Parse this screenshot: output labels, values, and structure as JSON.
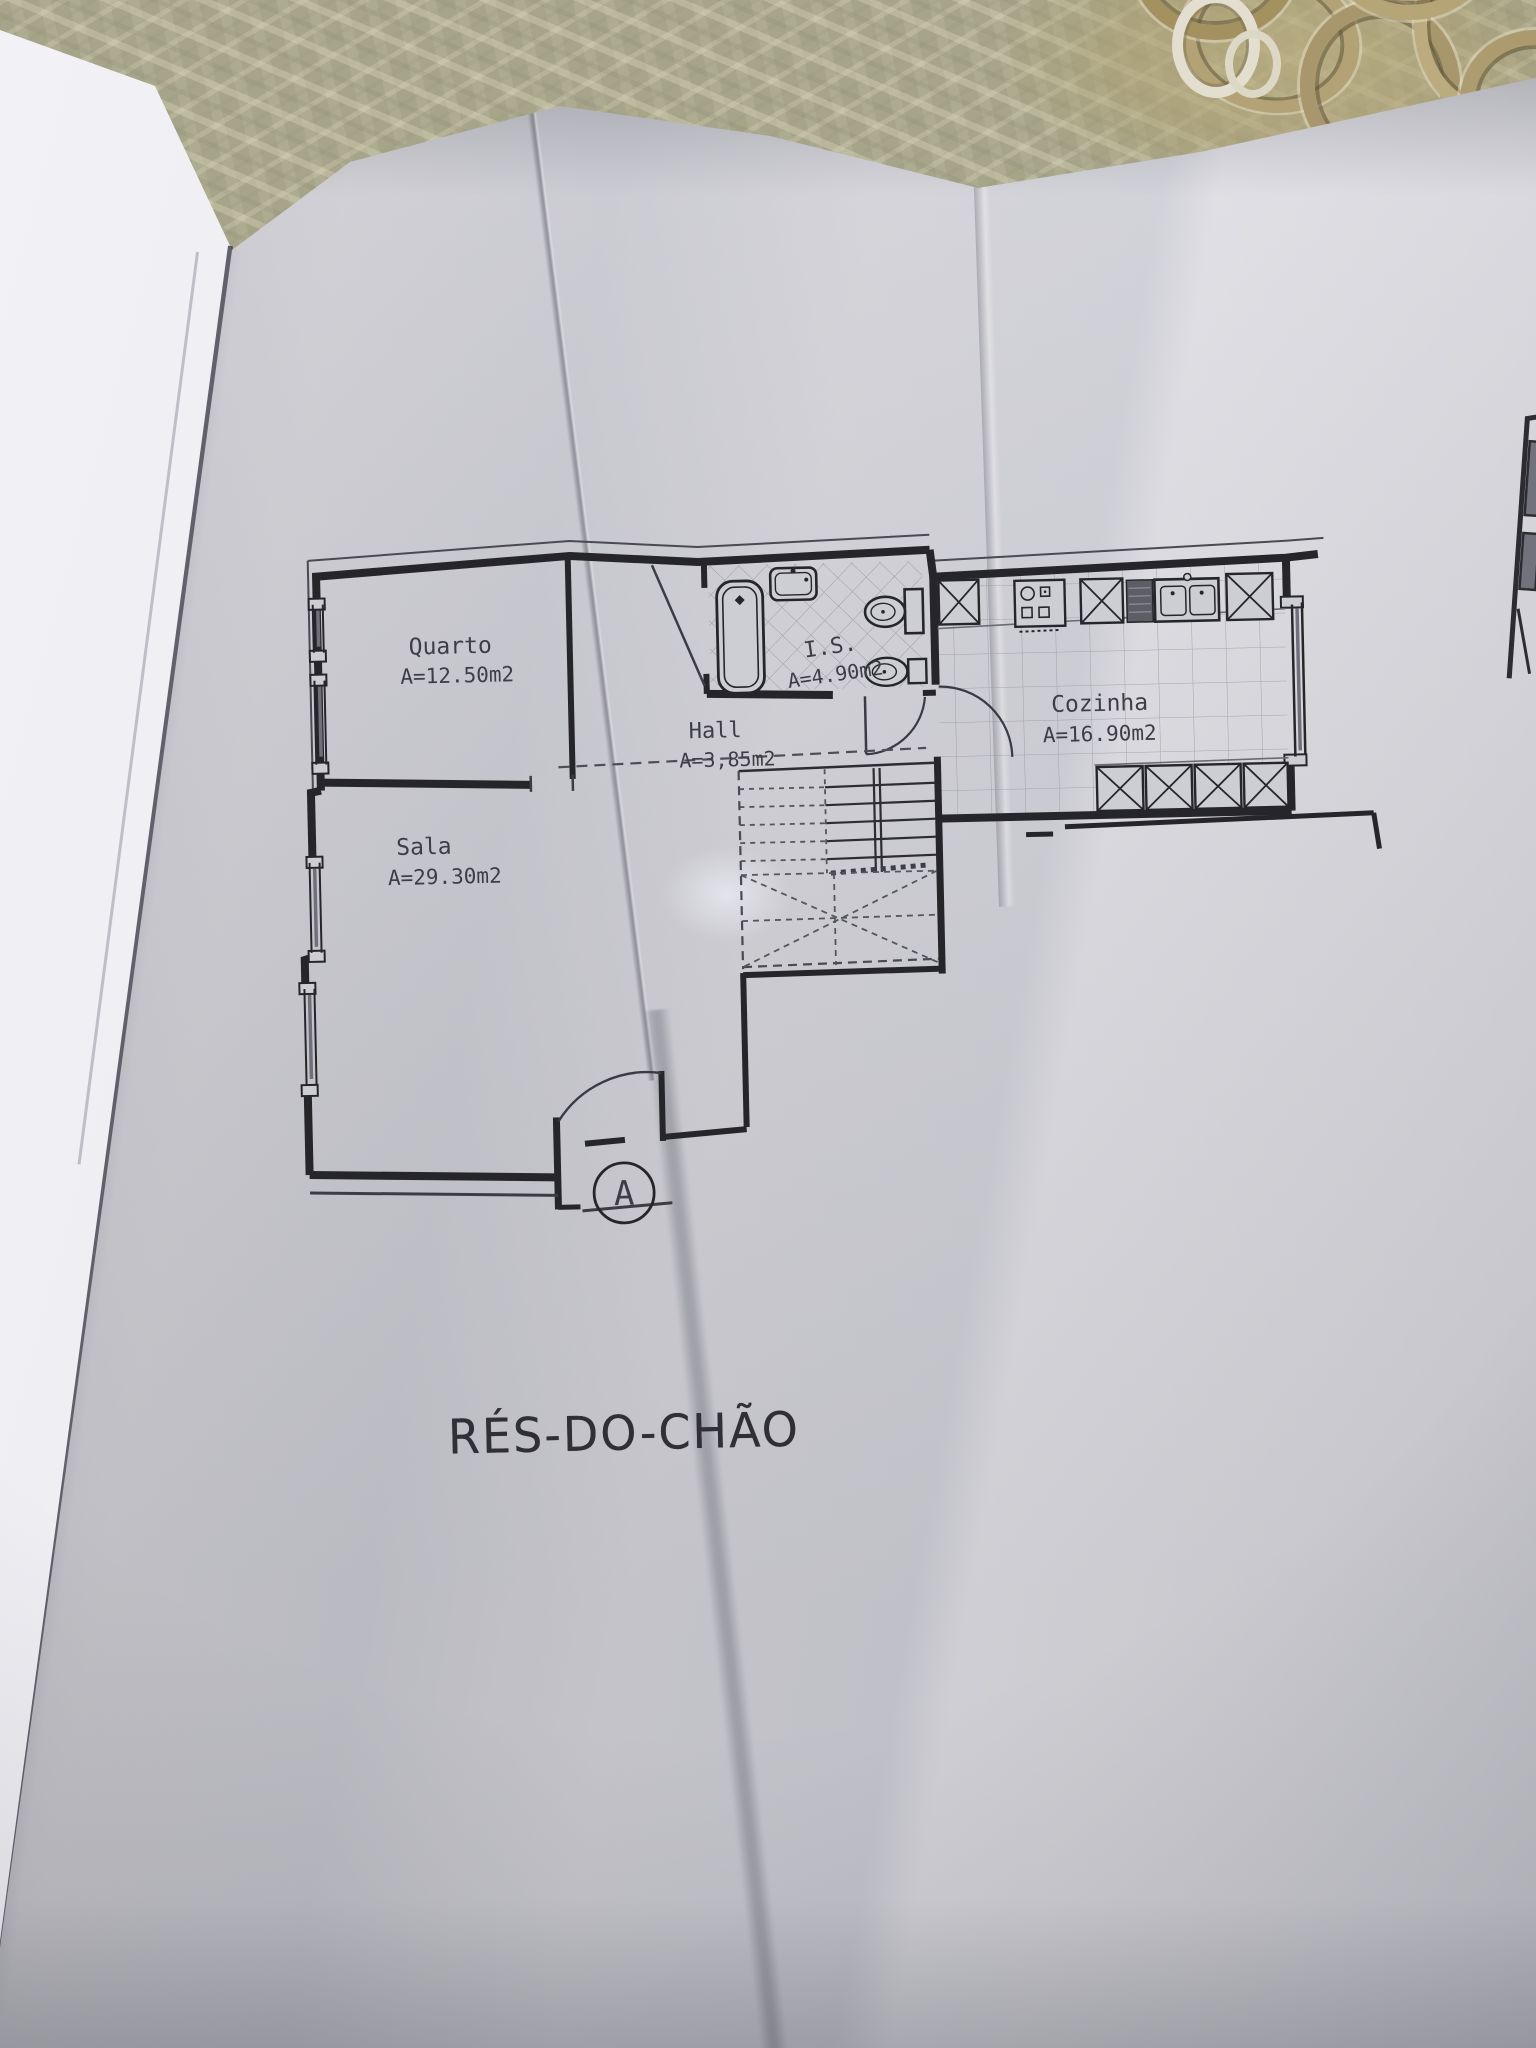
{
  "floor_plan": {
    "title": "RÉS-DO-CHÃO",
    "section_marker": "A",
    "rooms": [
      {
        "name": "Quarto",
        "area": "A=12.50m2"
      },
      {
        "name": "I.S.",
        "area": "A=4.90m2"
      },
      {
        "name": "Hall",
        "area": "A=3,85m2"
      },
      {
        "name": "Cozinha",
        "area": "A=16.90m2"
      },
      {
        "name": "Sala",
        "area": "A=29.30m2"
      }
    ]
  },
  "colors": {
    "paper": "#cfcfd6",
    "ink": "#26262a",
    "tile_line": "#9a9aa2",
    "tablecloth": "#a6a489",
    "doily_gold": "#b3a276",
    "page_white": "#ececf1"
  }
}
